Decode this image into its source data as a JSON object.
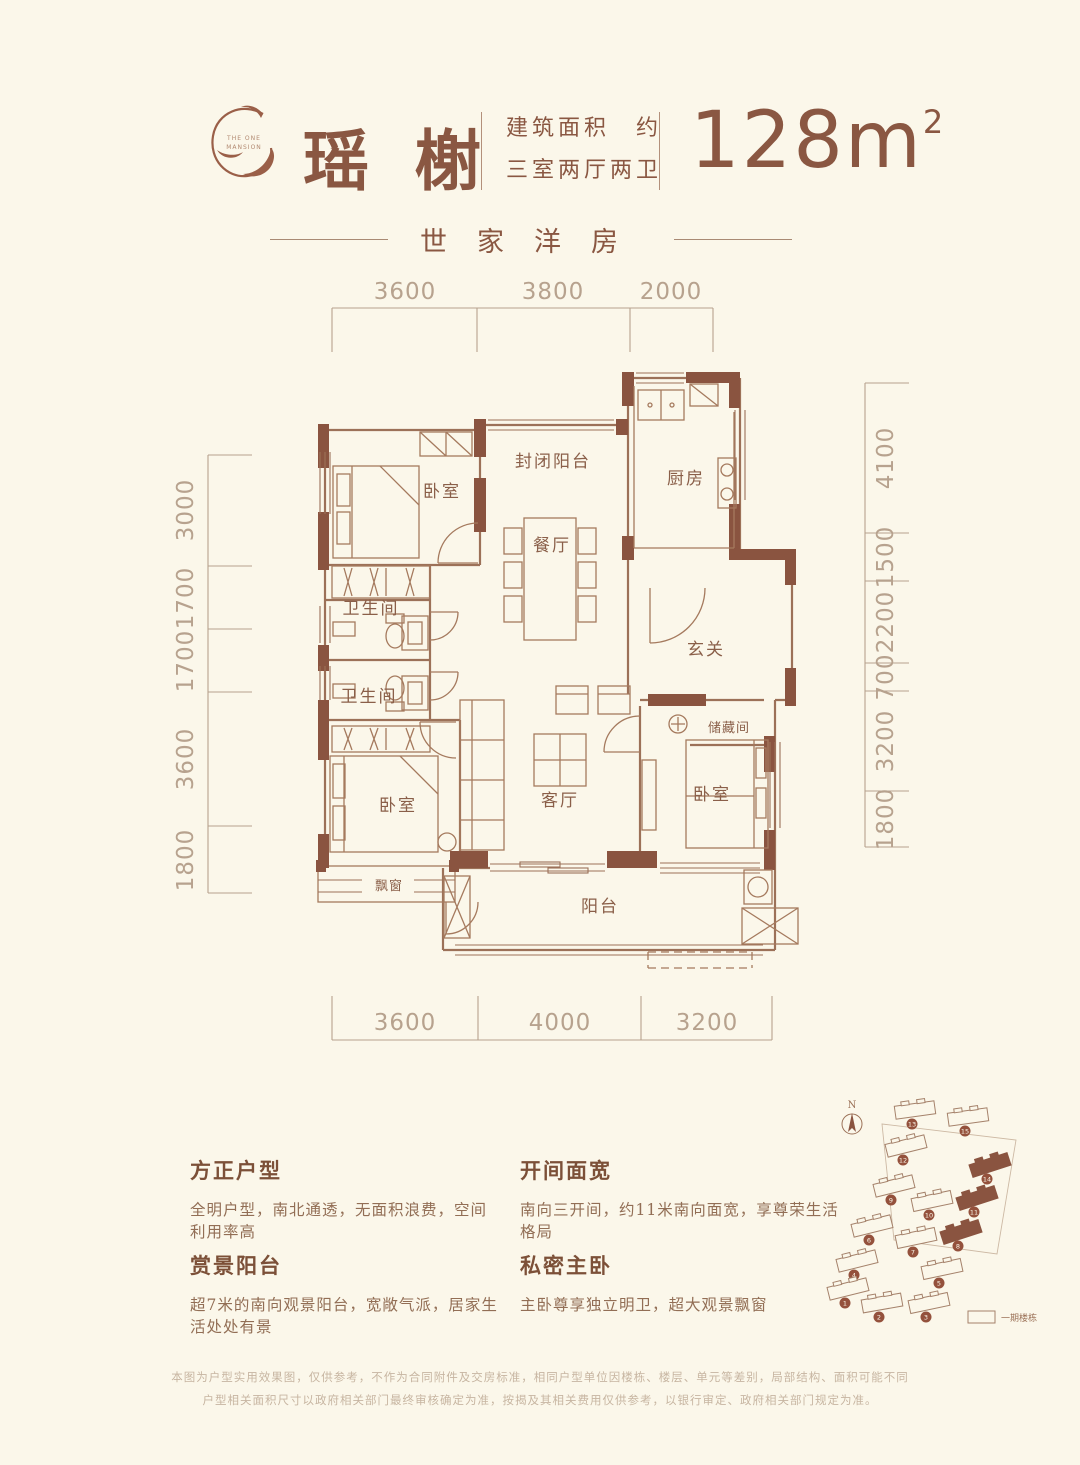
{
  "colors": {
    "background": "#fbf7ea",
    "brown_accent": "#8a5742",
    "wall_fill": "#8a5440",
    "dim_text": "#b7a28e",
    "disclaimer_text": "#c7b5a1"
  },
  "header": {
    "logo_line1": "THE ONE",
    "logo_line2": "MANSION",
    "title": "瑶榭",
    "spec1": "建筑面积　约",
    "spec2": "三室两厅两卫",
    "area_value": "128m",
    "area_sup": "2",
    "subtitle": "世家洋房"
  },
  "floorplan": {
    "rooms": {
      "bedroom_top": "卧室",
      "enclosed_balcony": "封闭阳台",
      "kitchen": "厨房",
      "dining": "餐厅",
      "bath_upper": "卫生间",
      "bath_lower": "卫生间",
      "foyer": "玄关",
      "storage": "储藏间",
      "living": "客厅",
      "bedroom_left": "卧室",
      "bedroom_right": "卧室",
      "bay_window": "飘窗",
      "balcony": "阳台"
    },
    "dims": {
      "top": [
        "3600",
        "3800",
        "2000"
      ],
      "bottom": [
        "3600",
        "4000",
        "3200"
      ],
      "left": [
        "3000",
        "1700",
        "1700",
        "3600",
        "1800"
      ],
      "right": [
        "4100",
        "1500",
        "2200",
        "700",
        "3200",
        "1800"
      ]
    }
  },
  "features": [
    {
      "title": "方正户型",
      "desc": "全明户型，南北通透，无面积浪费，空间利用率高"
    },
    {
      "title": "开间面宽",
      "desc": "南向三开间，约11米南向面宽，享尊荣生活格局"
    },
    {
      "title": "赏景阳台",
      "desc": "超7米的南向观景阳台，宽敞气派，居家生活处处有景"
    },
    {
      "title": "私密主卧",
      "desc": "主卧尊享独立明卫，超大观景飘窗"
    }
  ],
  "sitemap": {
    "north": "N",
    "legend": "一期楼栋",
    "markers": [
      {
        "num": "13",
        "x": 95,
        "y": 30,
        "rot": -8,
        "filled": false
      },
      {
        "num": "15",
        "x": 148,
        "y": 37,
        "rot": -8,
        "filled": false
      },
      {
        "num": "12",
        "x": 86,
        "y": 66,
        "rot": -14,
        "filled": false
      },
      {
        "num": "14",
        "x": 170,
        "y": 85,
        "rot": -18,
        "filled": true
      },
      {
        "num": "9",
        "x": 74,
        "y": 106,
        "rot": -14,
        "filled": false
      },
      {
        "num": "10",
        "x": 112,
        "y": 121,
        "rot": -12,
        "filled": false
      },
      {
        "num": "11",
        "x": 157,
        "y": 118,
        "rot": -18,
        "filled": true
      },
      {
        "num": "6",
        "x": 52,
        "y": 146,
        "rot": -14,
        "filled": false
      },
      {
        "num": "7",
        "x": 96,
        "y": 158,
        "rot": -12,
        "filled": false
      },
      {
        "num": "8",
        "x": 141,
        "y": 152,
        "rot": -18,
        "filled": true
      },
      {
        "num": "4",
        "x": 37,
        "y": 181,
        "rot": -14,
        "filled": false
      },
      {
        "num": "5",
        "x": 122,
        "y": 189,
        "rot": -12,
        "filled": false
      },
      {
        "num": "1",
        "x": 28,
        "y": 209,
        "rot": -14,
        "filled": false
      },
      {
        "num": "2",
        "x": 62,
        "y": 223,
        "rot": -10,
        "filled": false
      },
      {
        "num": "3",
        "x": 109,
        "y": 223,
        "rot": -12,
        "filled": false
      }
    ]
  },
  "disclaimer": [
    "本图为户型实用效果图，仅供参考，不作为合同附件及交房标准，相同户型单位因楼栋、楼层、单元等差别，局部结构、面积可能不同",
    "户型相关面积尺寸以政府相关部门最终审核确定为准，按揭及其相关费用仅供参考，以银行审定、政府相关部门规定为准。"
  ]
}
